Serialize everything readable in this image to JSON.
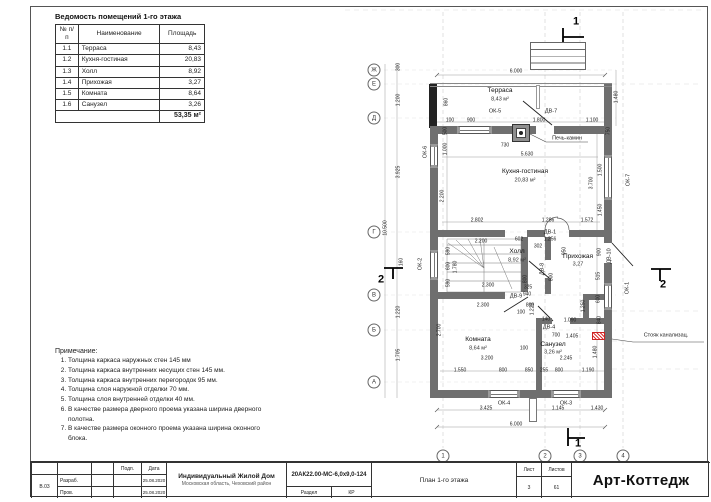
{
  "schedule": {
    "title": "Ведомость помещений 1-го этажа",
    "headers": [
      "№ п/п",
      "Наименование",
      "Площадь"
    ],
    "rows": [
      {
        "num": "1.1",
        "name": "Терраса",
        "area": "8,43"
      },
      {
        "num": "1.2",
        "name": "Кухня-гостиная",
        "area": "20,83"
      },
      {
        "num": "1.3",
        "name": "Холл",
        "area": "8,92"
      },
      {
        "num": "1.4",
        "name": "Прихожая",
        "area": "3,27"
      },
      {
        "num": "1.5",
        "name": "Комната",
        "area": "8,64"
      },
      {
        "num": "1.6",
        "name": "Санузел",
        "area": "3,26"
      }
    ],
    "total": "53,35 м²"
  },
  "notes": {
    "title": "Примечание:",
    "items": [
      "Толщина каркаса наружных стен 145 мм",
      "Толщина каркаса внутренних несущих стен 145 мм.",
      "Толщина каркаса внутренних перегородок 95 мм.",
      "Толщина слоя наружной отделки 70 мм.",
      "Толщина слоя внутренней отделки 40 мм.",
      "В качестве размера дверного проема указана ширина дверного полотна.",
      "В качестве размера оконного проема указана ширина оконного блока."
    ]
  },
  "titleblock": {
    "code": "В.03",
    "roles": [
      "Разраб.",
      "Пров."
    ],
    "sign_header": "Подп.",
    "date_header": "Дата",
    "dates": [
      "25.08.2020",
      "25.08.2020"
    ],
    "project": "Индивидуальный Жилой Дом",
    "location": "Московская область, Чеховский район",
    "doc_number": "20АК22.00-МС-6,0х9,0-124",
    "section_label": "Раздел",
    "section_value": "КР",
    "sheet_label": "Лист",
    "sheet_value": "3",
    "sheets_label": "Листов",
    "sheets_value": "61",
    "drawing_title": "План 1-го этажа",
    "brand": "Арт-Коттедж"
  },
  "plan": {
    "texts": [
      {
        "t": "Терраса",
        "x": 500,
        "y": 91,
        "c": "room",
        "n": "room-label-terrasa"
      },
      {
        "t": "8,43 м²",
        "x": 500,
        "y": 100,
        "c": "area",
        "n": "room-area"
      },
      {
        "t": "Кухня-гостиная",
        "x": 525,
        "y": 172,
        "c": "room",
        "n": "room-label-kitchen"
      },
      {
        "t": "20,83 м²",
        "x": 525,
        "y": 181,
        "c": "area",
        "n": "room-area"
      },
      {
        "t": "Холл",
        "x": 517,
        "y": 252,
        "c": "room",
        "n": "room-label-hall"
      },
      {
        "t": "8,92 м²",
        "x": 517,
        "y": 261,
        "c": "area",
        "n": "room-area"
      },
      {
        "t": "Прихожая",
        "x": 578,
        "y": 257,
        "c": "room",
        "n": "room-label-prihozhaya"
      },
      {
        "t": "3,27",
        "x": 578,
        "y": 265,
        "c": "area",
        "n": "room-area"
      },
      {
        "t": "Комната",
        "x": 478,
        "y": 340,
        "c": "room",
        "n": "room-label-komnata"
      },
      {
        "t": "8,64 м²",
        "x": 478,
        "y": 349,
        "c": "area",
        "n": "room-area"
      },
      {
        "t": "Санузел",
        "x": 553,
        "y": 345,
        "c": "room",
        "n": "room-label-sanuzel"
      },
      {
        "t": "3,26 м²",
        "x": 553,
        "y": 353,
        "c": "area",
        "n": "room-area"
      },
      {
        "t": "ОК-5",
        "x": 495,
        "y": 112,
        "c": "tag",
        "n": "window-tag"
      },
      {
        "t": "ДВ-7",
        "x": 551,
        "y": 112,
        "c": "tag",
        "n": "door-tag"
      },
      {
        "t": "ОК-6",
        "x": 426,
        "y": 152,
        "c": "tag",
        "r": 1,
        "n": "window-tag"
      },
      {
        "t": "ОК-2",
        "x": 421,
        "y": 264,
        "c": "tag",
        "r": 1,
        "n": "window-tag"
      },
      {
        "t": "ОК-7",
        "x": 629,
        "y": 180,
        "c": "tag",
        "r": 1,
        "n": "window-tag"
      },
      {
        "t": "ОК-1",
        "x": 628,
        "y": 288,
        "c": "tag",
        "r": 1,
        "n": "window-tag"
      },
      {
        "t": "ДВ-8",
        "x": 543,
        "y": 269,
        "c": "tag",
        "r": 1,
        "n": "door-tag"
      },
      {
        "t": "ДВ-10",
        "x": 610,
        "y": 256,
        "c": "tag",
        "r": 1,
        "n": "door-tag"
      },
      {
        "t": "ДВ-9",
        "x": 516,
        "y": 297,
        "c": "tag",
        "n": "door-tag"
      },
      {
        "t": "ДВ-4",
        "x": 549,
        "y": 328,
        "c": "tag",
        "n": "door-tag"
      },
      {
        "t": "ДВ-1",
        "x": 550,
        "y": 233,
        "c": "tag",
        "n": "door-tag"
      },
      {
        "t": "ОК-4",
        "x": 504,
        "y": 404,
        "c": "tag",
        "n": "window-tag"
      },
      {
        "t": "ОК-3",
        "x": 566,
        "y": 404,
        "c": "tag",
        "n": "window-tag"
      },
      {
        "t": "Печь-камин",
        "x": 567,
        "y": 139,
        "c": "tag",
        "n": "fireplace-label"
      },
      {
        "t": "Стояк канализац.",
        "x": 666,
        "y": 336,
        "c": "tag",
        "n": "sewer-riser-label"
      },
      {
        "t": "6.000",
        "x": 516,
        "y": 72
      },
      {
        "t": "100",
        "x": 450,
        "y": 121
      },
      {
        "t": "900",
        "x": 471,
        "y": 121
      },
      {
        "t": "1.800",
        "x": 539,
        "y": 121
      },
      {
        "t": "1.100",
        "x": 592,
        "y": 121
      },
      {
        "t": "860",
        "x": 447,
        "y": 102,
        "r": 1
      },
      {
        "t": "1.480",
        "x": 617,
        "y": 97,
        "r": 1
      },
      {
        "t": "750",
        "x": 609,
        "y": 131,
        "r": 1
      },
      {
        "t": "500",
        "x": 446,
        "y": 131,
        "r": 1
      },
      {
        "t": "1.000",
        "x": 446,
        "y": 149,
        "r": 1
      },
      {
        "t": "2.200",
        "x": 443,
        "y": 196,
        "r": 1
      },
      {
        "t": "730",
        "x": 505,
        "y": 146
      },
      {
        "t": "5.630",
        "x": 527,
        "y": 155
      },
      {
        "t": "1.500",
        "x": 601,
        "y": 170,
        "r": 1
      },
      {
        "t": "3.700",
        "x": 592,
        "y": 183,
        "r": 1
      },
      {
        "t": "1.450",
        "x": 601,
        "y": 210,
        "r": 1
      },
      {
        "t": "2.802",
        "x": 477,
        "y": 221
      },
      {
        "t": "1.286",
        "x": 548,
        "y": 221
      },
      {
        "t": "1.572",
        "x": 587,
        "y": 221
      },
      {
        "t": "1.256",
        "x": 550,
        "y": 240
      },
      {
        "t": "602",
        "x": 519,
        "y": 240
      },
      {
        "t": "302",
        "x": 538,
        "y": 247
      },
      {
        "t": "2.200",
        "x": 481,
        "y": 242
      },
      {
        "t": "590",
        "x": 449,
        "y": 251,
        "r": 1
      },
      {
        "t": "600",
        "x": 449,
        "y": 266,
        "r": 1
      },
      {
        "t": "590",
        "x": 449,
        "y": 283,
        "r": 1
      },
      {
        "t": "1.780",
        "x": 456,
        "y": 267,
        "r": 1
      },
      {
        "t": "2.300",
        "x": 488,
        "y": 286
      },
      {
        "t": "800",
        "x": 526,
        "y": 279,
        "r": 1
      },
      {
        "t": "325",
        "x": 528,
        "y": 288
      },
      {
        "t": "2.300",
        "x": 483,
        "y": 306
      },
      {
        "t": "800",
        "x": 530,
        "y": 306
      },
      {
        "t": "100",
        "x": 521,
        "y": 313
      },
      {
        "t": "950",
        "x": 565,
        "y": 251,
        "r": 1
      },
      {
        "t": "900",
        "x": 600,
        "y": 252,
        "r": 1
      },
      {
        "t": "800",
        "x": 552,
        "y": 277,
        "r": 1
      },
      {
        "t": "515",
        "x": 599,
        "y": 276,
        "r": 1
      },
      {
        "t": "600",
        "x": 599,
        "y": 299,
        "r": 1
      },
      {
        "t": "840",
        "x": 600,
        "y": 320,
        "r": 1
      },
      {
        "t": "1.250",
        "x": 584,
        "y": 306,
        "r": 1
      },
      {
        "t": "1.220",
        "x": 533,
        "y": 309,
        "r": 1
      },
      {
        "t": "940",
        "x": 527,
        "y": 295
      },
      {
        "t": "1.090",
        "x": 570,
        "y": 321
      },
      {
        "t": "140",
        "x": 546,
        "y": 320
      },
      {
        "t": "700",
        "x": 556,
        "y": 336
      },
      {
        "t": "1.405",
        "x": 572,
        "y": 337
      },
      {
        "t": "2.245",
        "x": 566,
        "y": 359
      },
      {
        "t": "100",
        "x": 524,
        "y": 349
      },
      {
        "t": "3.200",
        "x": 487,
        "y": 359
      },
      {
        "t": "2.700",
        "x": 440,
        "y": 330,
        "r": 1
      },
      {
        "t": "1.480",
        "x": 596,
        "y": 352,
        "r": 1
      },
      {
        "t": "1.550",
        "x": 460,
        "y": 371
      },
      {
        "t": "800",
        "x": 503,
        "y": 371
      },
      {
        "t": "850",
        "x": 529,
        "y": 371
      },
      {
        "t": "255",
        "x": 544,
        "y": 371
      },
      {
        "t": "800",
        "x": 559,
        "y": 371
      },
      {
        "t": "1.190",
        "x": 588,
        "y": 371
      },
      {
        "t": "3.425",
        "x": 486,
        "y": 409
      },
      {
        "t": "1.145",
        "x": 558,
        "y": 409
      },
      {
        "t": "1.430",
        "x": 597,
        "y": 409
      },
      {
        "t": "6.000",
        "x": 516,
        "y": 425
      },
      {
        "t": "300",
        "x": 399,
        "y": 67,
        "r": 1
      },
      {
        "t": "1.200",
        "x": 399,
        "y": 100,
        "r": 1
      },
      {
        "t": "3.925",
        "x": 399,
        "y": 172,
        "r": 1
      },
      {
        "t": "10.500",
        "x": 386,
        "y": 228,
        "r": 1
      },
      {
        "t": "160",
        "x": 402,
        "y": 262,
        "r": 1
      },
      {
        "t": "1.220",
        "x": 399,
        "y": 312,
        "r": 1
      },
      {
        "t": "1.705",
        "x": 399,
        "y": 355,
        "r": 1
      }
    ],
    "bubbles": [
      {
        "t": "Ж",
        "x": 374,
        "y": 70
      },
      {
        "t": "Е",
        "x": 374,
        "y": 84
      },
      {
        "t": "Д",
        "x": 374,
        "y": 118
      },
      {
        "t": "Г",
        "x": 374,
        "y": 232
      },
      {
        "t": "В",
        "x": 374,
        "y": 295
      },
      {
        "t": "Б",
        "x": 374,
        "y": 330
      },
      {
        "t": "А",
        "x": 374,
        "y": 382
      },
      {
        "t": "1",
        "x": 443,
        "y": 456
      },
      {
        "t": "2",
        "x": 545,
        "y": 456
      },
      {
        "t": "3",
        "x": 580,
        "y": 456
      },
      {
        "t": "4",
        "x": 623,
        "y": 456
      }
    ],
    "sections": [
      {
        "t": "1",
        "x": 576,
        "y": 22
      },
      {
        "t": "1",
        "x": 578,
        "y": 444
      },
      {
        "t": "2",
        "x": 381,
        "y": 280
      },
      {
        "t": "2",
        "x": 663,
        "y": 285
      }
    ]
  }
}
